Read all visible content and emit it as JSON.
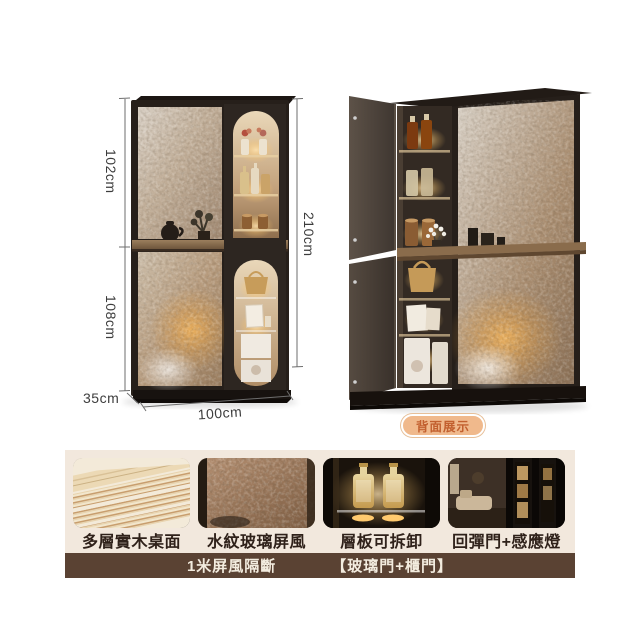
{
  "product": {
    "dimensions": {
      "upper_height": "102cm",
      "lower_height": "108cm",
      "total_height": "210cm",
      "depth": "35cm",
      "width": "100cm"
    },
    "back_view_badge": "背面展示",
    "features": [
      {
        "label": "多層實木桌面"
      },
      {
        "label": "水紋玻璃屏風"
      },
      {
        "label": "層板可拆卸"
      },
      {
        "label": "回彈門+感應燈"
      }
    ],
    "bottom_bar": {
      "left_text": "1米屏風隔斷",
      "right_text": "【玻璃門+櫃門】"
    }
  },
  "colors": {
    "panel_bg": "#f2e8dd",
    "bar_bg": "#5a4233",
    "badge_bg": "#f0b98c",
    "badge_text": "#c2602f",
    "caption_text": "#2f211a",
    "dimension_text": "#3d3d3d",
    "cabinet_frame": "#261f1a",
    "glass_bronze": "#b69a7c",
    "wood_shelf": "#8a6c4c"
  }
}
